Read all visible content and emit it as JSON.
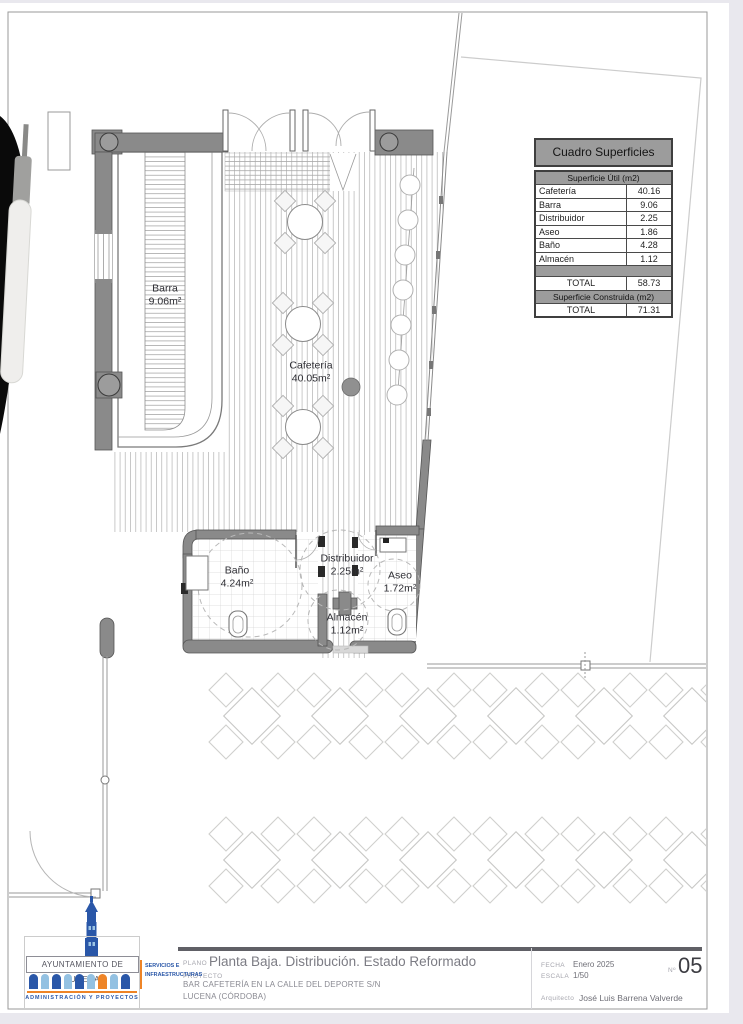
{
  "surfaces_table": {
    "title": "Cuadro Superficies",
    "header_util": "Superficie Útil (m2)",
    "rows": [
      {
        "label": "Cafetería",
        "value": "40.16"
      },
      {
        "label": "Barra",
        "value": "9.06"
      },
      {
        "label": "Distribuidor",
        "value": "2.25"
      },
      {
        "label": "Aseo",
        "value": "1.86"
      },
      {
        "label": "Baño",
        "value": "4.28"
      },
      {
        "label": "Almacén",
        "value": "1.12"
      }
    ],
    "total_util": {
      "label": "TOTAL",
      "value": "58.73"
    },
    "header_construida": "Superficie Construida (m2)",
    "total_construida": {
      "label": "TOTAL",
      "value": "71.31"
    }
  },
  "plan_labels": {
    "barra": {
      "name": "Barra",
      "area": "9.06m²"
    },
    "cafeteria": {
      "name": "Cafetería",
      "area": "40.05m²"
    },
    "bano": {
      "name": "Baño",
      "area": "4.24m²"
    },
    "distribuidor": {
      "name": "Distribuidor",
      "area": "2.25m²"
    },
    "aseo": {
      "name": "Aseo",
      "area": "1.72m²"
    },
    "almacen": {
      "name": "Almacén",
      "area": "1.12m²"
    }
  },
  "title_block": {
    "plano_label": "PLANO",
    "plano": "Planta Baja. Distribución. Estado Reformado",
    "proyecto_label": "PROYECTO",
    "proyecto_line1": "BAR CAFETERÍA EN LA CALLE DEL DEPORTE S/N",
    "proyecto_line2": "LUCENA (CÓRDOBA)",
    "fecha_label": "FECHA",
    "fecha": "Enero 2025",
    "escala_label": "ESCALA",
    "escala": "1/50",
    "numero_label": "Nº",
    "numero": "05",
    "arquitecto_label": "Arquitecto",
    "arquitecto": "José Luis Barrena Valverde"
  },
  "logo": {
    "name": "AYUNTAMIENTO  DE  LUCENA",
    "sub": "ADMINISTRACIÓN Y PROYECTOS",
    "services_line1": "SERVICIOS E",
    "services_line2": "INFRAESTRUCTURAS",
    "colors": {
      "dark_blue": "#2a57a8",
      "light_blue": "#93c1e2",
      "orange": "#ee8427"
    },
    "arches": [
      "dark",
      "light",
      "dark",
      "light",
      "dark",
      "light",
      "orange",
      "light",
      "dark"
    ]
  }
}
